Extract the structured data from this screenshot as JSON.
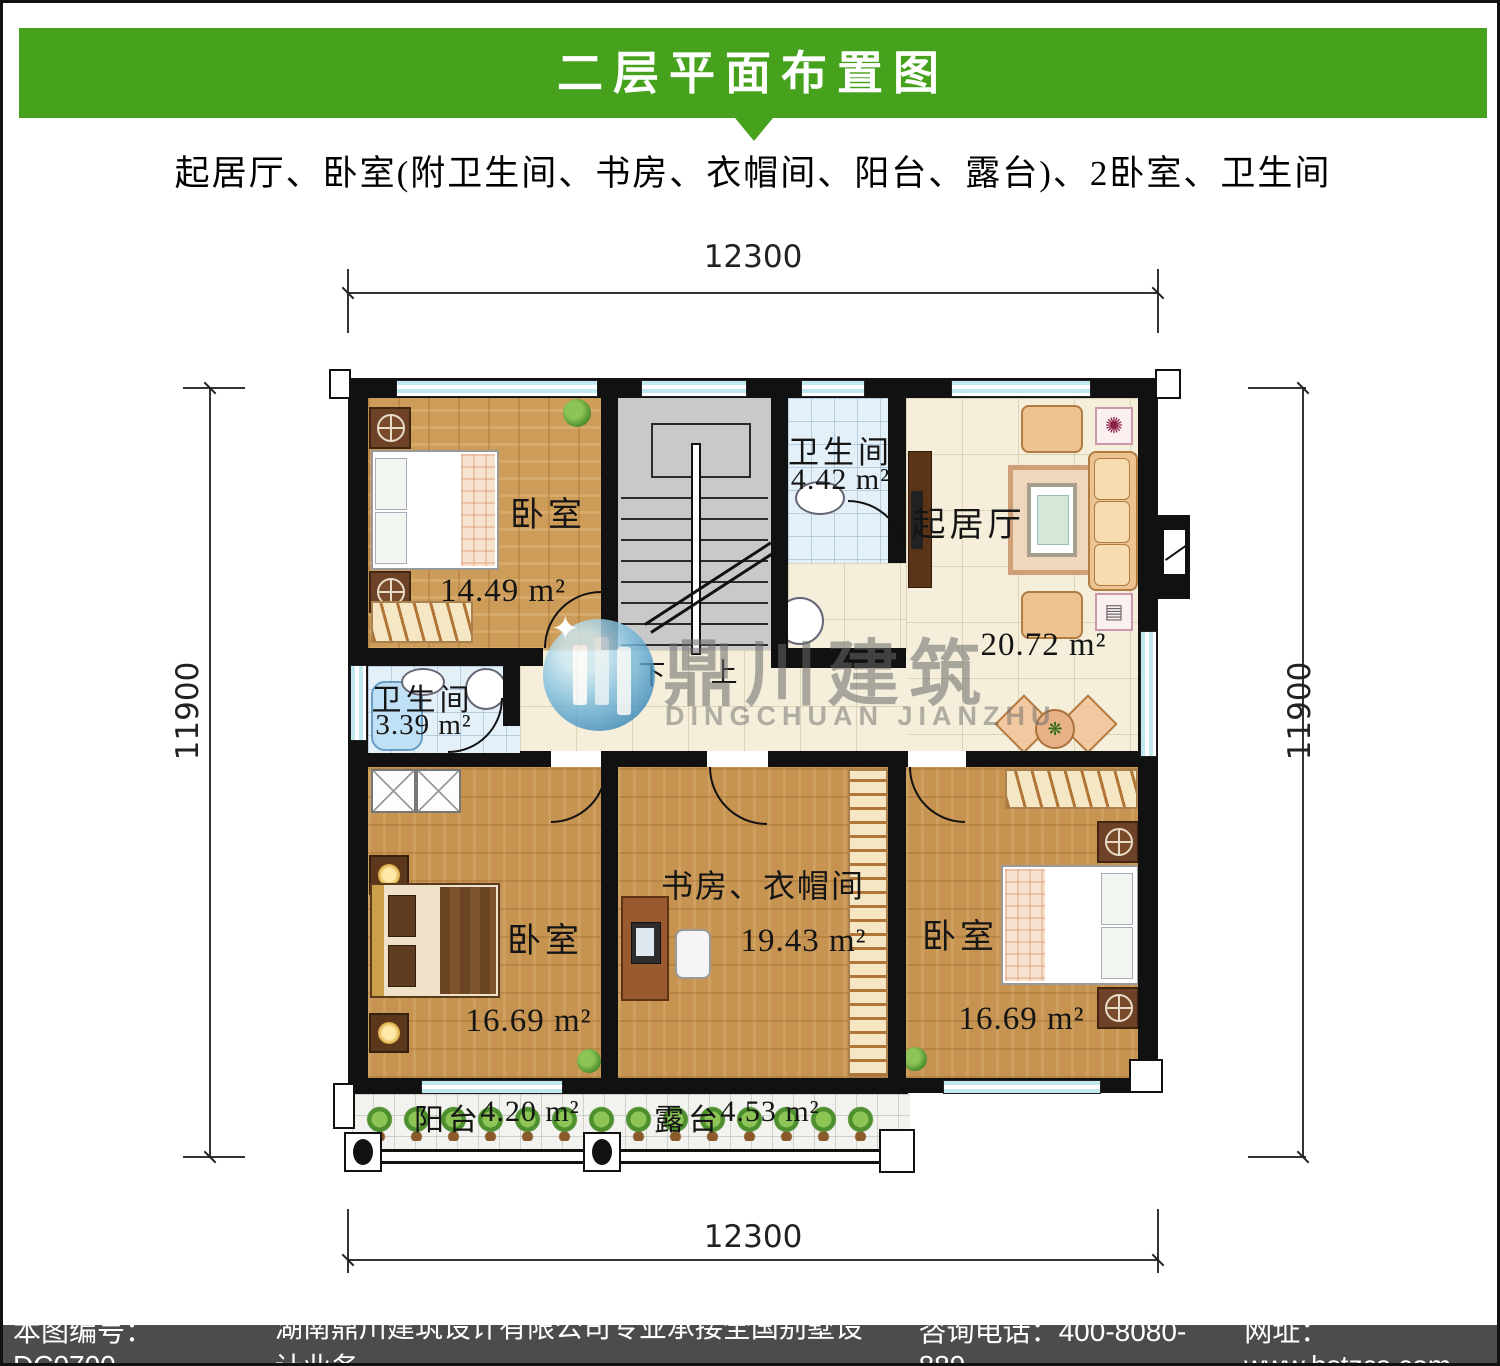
{
  "header": {
    "title": "二层平面布置图",
    "subtitle": "起居厅、卧室(附卫生间、书房、衣帽间、阳台、露台)、2卧室、卫生间"
  },
  "dims": {
    "top": "12300",
    "bottom": "12300",
    "left": "11900",
    "right": "11900"
  },
  "rooms": [
    {
      "id": "bedroom-top-left",
      "name": "卧室",
      "area": "14.49 m²"
    },
    {
      "id": "bathroom-top",
      "name": "卫生间",
      "area": "4.42 m²"
    },
    {
      "id": "living-room",
      "name": "起居厅",
      "area": "20.72 m²"
    },
    {
      "id": "bathroom-middle",
      "name": "卫生间",
      "area": "3.39 m²"
    },
    {
      "id": "bedroom-bottom-left",
      "name": "卧室",
      "area": "16.69 m²"
    },
    {
      "id": "study-cloakroom",
      "name": "书房、衣帽间",
      "area": "19.43 m²"
    },
    {
      "id": "bedroom-bottom-right",
      "name": "卧室",
      "area": "16.69 m²"
    },
    {
      "id": "balcony",
      "name": "阳台",
      "area": "4.20 m²"
    },
    {
      "id": "terrace",
      "name": "露台",
      "area": "4.53 m²"
    }
  ],
  "stairs": {
    "down_label": "下",
    "up_label": "上"
  },
  "watermark": {
    "cn": "鼎川建筑",
    "en": "DINGCHUAN JIANZHU"
  },
  "footer": {
    "code": "本图编号：DC0700",
    "company": "湖南鼎川建筑设计有限公司专业承接全国别墅设计业务",
    "phone": "咨询电话：400-8080-889",
    "website": "网址：www.bstzcs.com"
  },
  "colors": {
    "banner_green": "#46a21c",
    "footer_gray": "#4c4c4c",
    "wall_black": "#111111",
    "window_blue": "#bfe9ee"
  }
}
